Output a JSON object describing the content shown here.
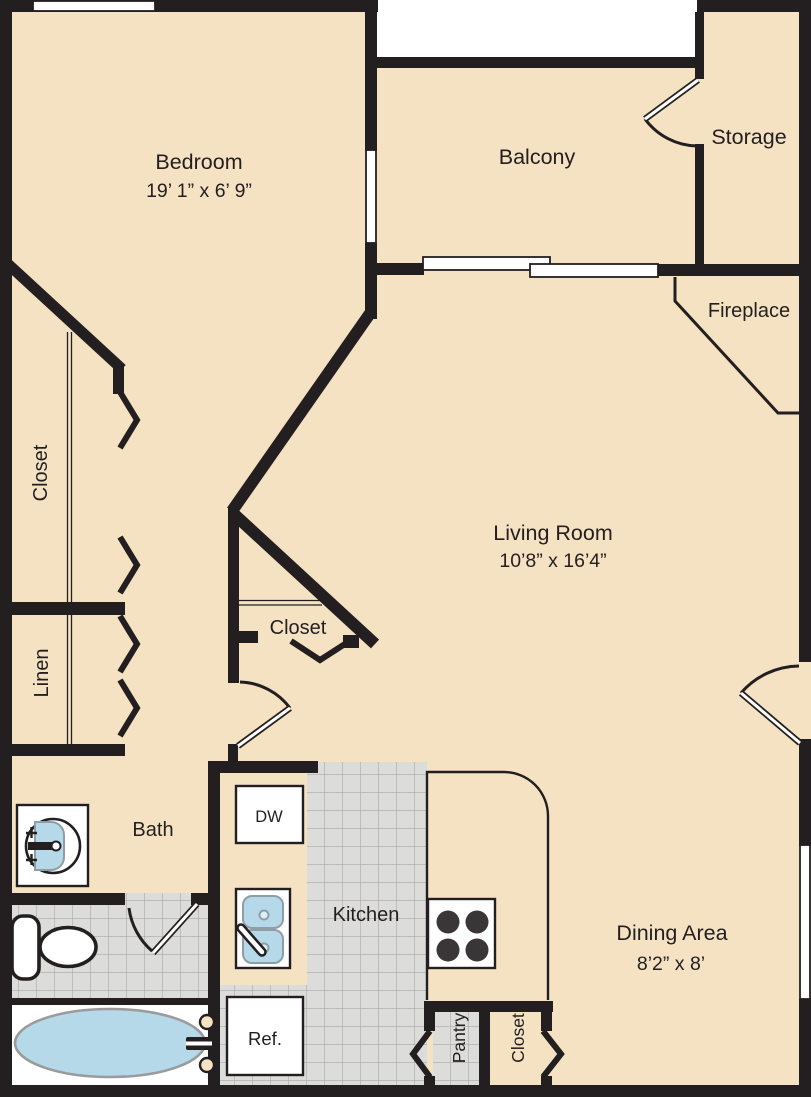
{
  "plan": {
    "rooms": {
      "bedroom": {
        "label": "Bedroom",
        "dims": "19’ 1” x 6’ 9”"
      },
      "balcony": {
        "label": "Balcony"
      },
      "storage": {
        "label": "Storage"
      },
      "fireplace": {
        "label": "Fireplace"
      },
      "living_room": {
        "label": "Living Room",
        "dims": "10’8” x 16’4”"
      },
      "dining_area": {
        "label": "Dining Area",
        "dims": "8’2” x 8’"
      },
      "kitchen": {
        "label": "Kitchen"
      },
      "bath": {
        "label": "Bath"
      },
      "closet_left": {
        "label": "Closet"
      },
      "closet_center": {
        "label": "Closet"
      },
      "closet_bottom": {
        "label": "Closet"
      },
      "linen": {
        "label": "Linen"
      },
      "pantry": {
        "label": "Pantry"
      }
    },
    "fixtures": {
      "dishwasher": {
        "label": "DW"
      },
      "refrigerator": {
        "label": "Ref."
      }
    },
    "colors": {
      "floor": "#f4e2c3",
      "wall": "#231f20",
      "tile": "#dcdcda",
      "tile_line": "#aaa9a7",
      "water_blue": "#b5d9e9",
      "fixture_outline": "#8f9ea6",
      "exterior": "#ffffff"
    }
  }
}
